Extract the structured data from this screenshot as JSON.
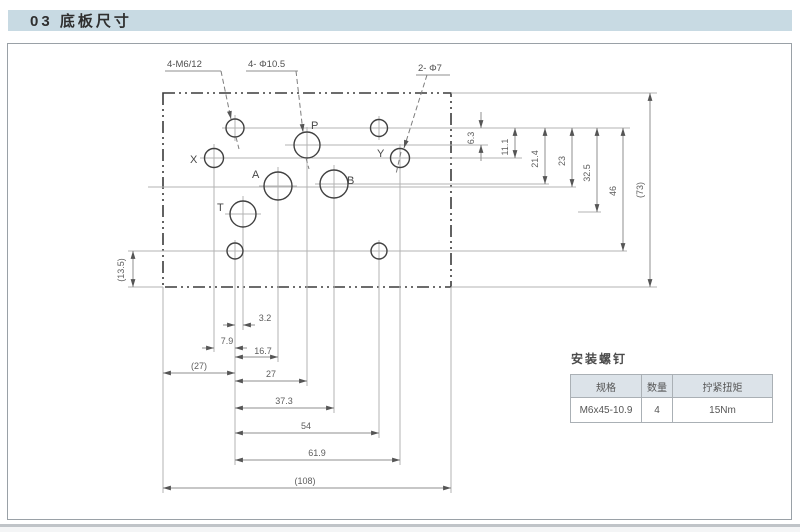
{
  "header": {
    "title": "03 底板尺寸"
  },
  "drawing": {
    "callouts": {
      "mounting_holes": "4-M6/12",
      "main_ports": "4- Φ10.5",
      "pilot_ports": "2- Φ7"
    },
    "port_labels": {
      "p": "P",
      "a": "A",
      "b": "B",
      "t": "T",
      "x": "X",
      "y": "Y"
    },
    "dims": {
      "right": [
        "6.3",
        "11.1",
        "21.4",
        "23",
        "32.5",
        "46",
        "(73)"
      ],
      "bottom": [
        "3.2",
        "7.9",
        "16.7",
        "27",
        "37.3",
        "54",
        "61.9",
        "(108)",
        "(27)"
      ],
      "left": "(13.5)"
    }
  },
  "screw_table": {
    "title": "安装螺钉",
    "headers": [
      "规格",
      "数量",
      "拧紧扭矩"
    ],
    "row": [
      "M6x45-10.9",
      "4",
      "15Nm"
    ]
  },
  "colors": {
    "header_bar_bg": "#c8dae3",
    "table_header_bg": "#dce3e9",
    "line_dark": "#3b3b3b",
    "line_light": "#b3b3b3"
  }
}
